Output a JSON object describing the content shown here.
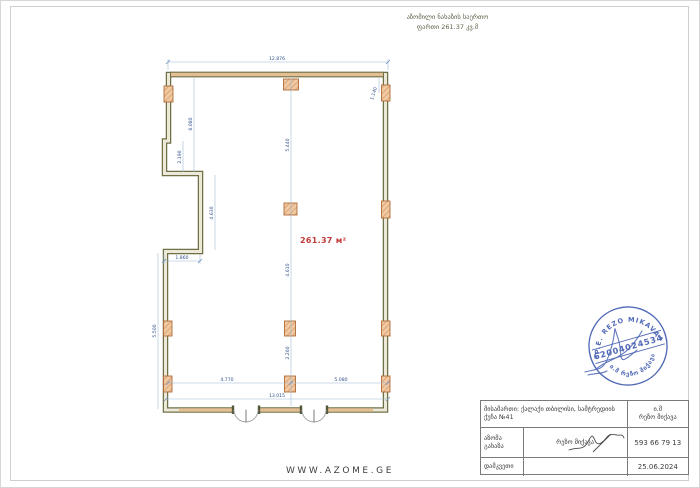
{
  "header": {
    "title_line1": "აზომილი ნახაზის საერთო",
    "title_line2": "ფართი 261.37 კვ.მ"
  },
  "plan": {
    "area_label": "261.37 м²",
    "dimensions": {
      "top_total": "12.876",
      "top_right": "1.140",
      "left_upper": "6.080",
      "left_step": "2.190",
      "notch_vertical": "4.630",
      "notch_width": "1.860",
      "left_lower": "5.500",
      "center_upper": "5.440",
      "center_middle": "4.610",
      "center_lower": "2.260",
      "bottom_left": "4.770",
      "bottom_right": "5.080",
      "bottom_total": "13.015"
    }
  },
  "stamp": {
    "arc_top": "P.E. REZO MIKAVA",
    "number": "62004024534",
    "star": "✱",
    "arc_bottom": "ი.მ რეზო მიქავა",
    "color": "#3a55ac"
  },
  "watermark": "WWW.AZOME.GE",
  "title_block": {
    "address": "მისამართი: ქალაქი თბილისი, სამტრედიის ქუჩა №41",
    "company_line1": "ი.მ",
    "company_line2": "რეზო მიქავა",
    "surveyor_label": "აზომა გახაზა",
    "surveyor_name": "რეზო მიქავა",
    "phone": "593 66 79 13",
    "client_label": "დამკვეთი",
    "date": "25.06.2024"
  },
  "colors": {
    "wall": "#6f7045",
    "wall_core": "#ece9d8",
    "masonry": "#e4bf93",
    "column_fill": "#f0c9a2",
    "column_edge": "#b06a38",
    "dimension_line": "#9db8d2",
    "dimension_text": "#31518a",
    "area_text": "#c23b3b",
    "stamp_blue": "#3a55ac"
  }
}
